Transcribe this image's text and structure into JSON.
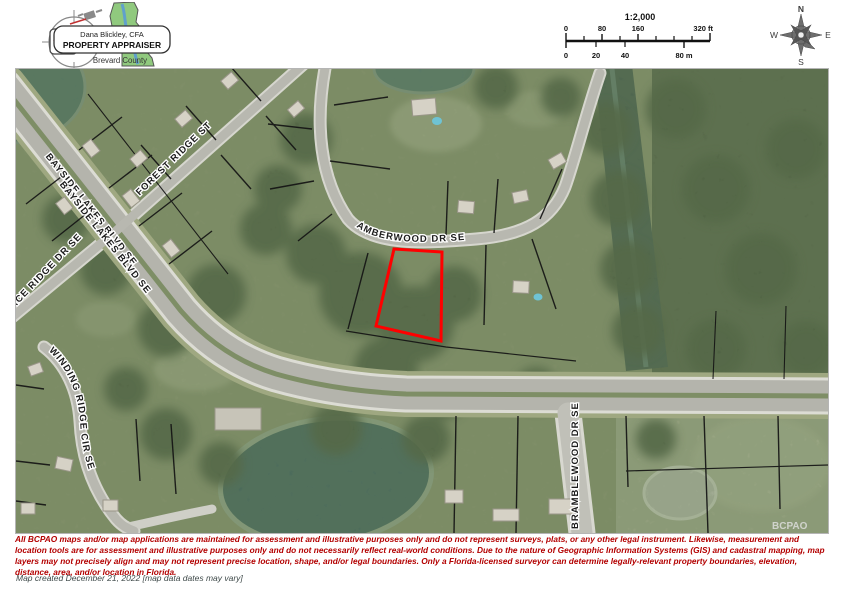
{
  "header": {
    "logo": {
      "appraiser_name": "Dana Blickley, CFA",
      "title": "PROPERTY APPRAISER",
      "county": "Brevard County"
    },
    "scale": {
      "ratio": "1:2,000",
      "ft": [
        "0",
        "80",
        "160",
        "320 ft"
      ],
      "m": [
        "0",
        "20",
        "40",
        "80 m"
      ]
    },
    "compass": {
      "n": "N",
      "e": "E",
      "s": "S",
      "w": "W"
    }
  },
  "map": {
    "streets": [
      {
        "id": "bayside-1",
        "label": "BAYSIDE LAKES BLVD SE"
      },
      {
        "id": "bayside-2",
        "label": "BAYSIDE LAKES BLVD SE"
      },
      {
        "id": "forest",
        "label": "FOREST RIDGE ST"
      },
      {
        "id": "trace",
        "label": "TRACE RIDGE DR SE"
      },
      {
        "id": "amberwood",
        "label": "AMBERWOOD DR SE"
      },
      {
        "id": "winding",
        "label": "WINDING RIDGE CIR SE"
      },
      {
        "id": "bramblewood",
        "label": "BRAMBLEWOOD DR SE"
      }
    ],
    "watermark": "BCPAO",
    "highlight_color": "#ff0000",
    "parcel_line_color": "#141414"
  },
  "footer": {
    "disclaimer": "All BCPAO maps and/or map applications are maintained for assessment and illustrative purposes only and do not represent surveys, plats, or any other legal instrument. Likewise, measurement and location tools are for assessment and illustrative purposes only and do not necessarily reflect real-world conditions. Due to the nature of Geographic Information Systems (GIS) and cadastral mapping, map layers may not precisely align and may not represent precise location, shape, and/or legal boundaries. Only a Florida-licensed surveyor can determine legally-relevant property boundaries, elevation, distance, area, and/or location in Florida.",
    "map_created": "Map created December 21, 2022 [map data dates may vary]"
  }
}
